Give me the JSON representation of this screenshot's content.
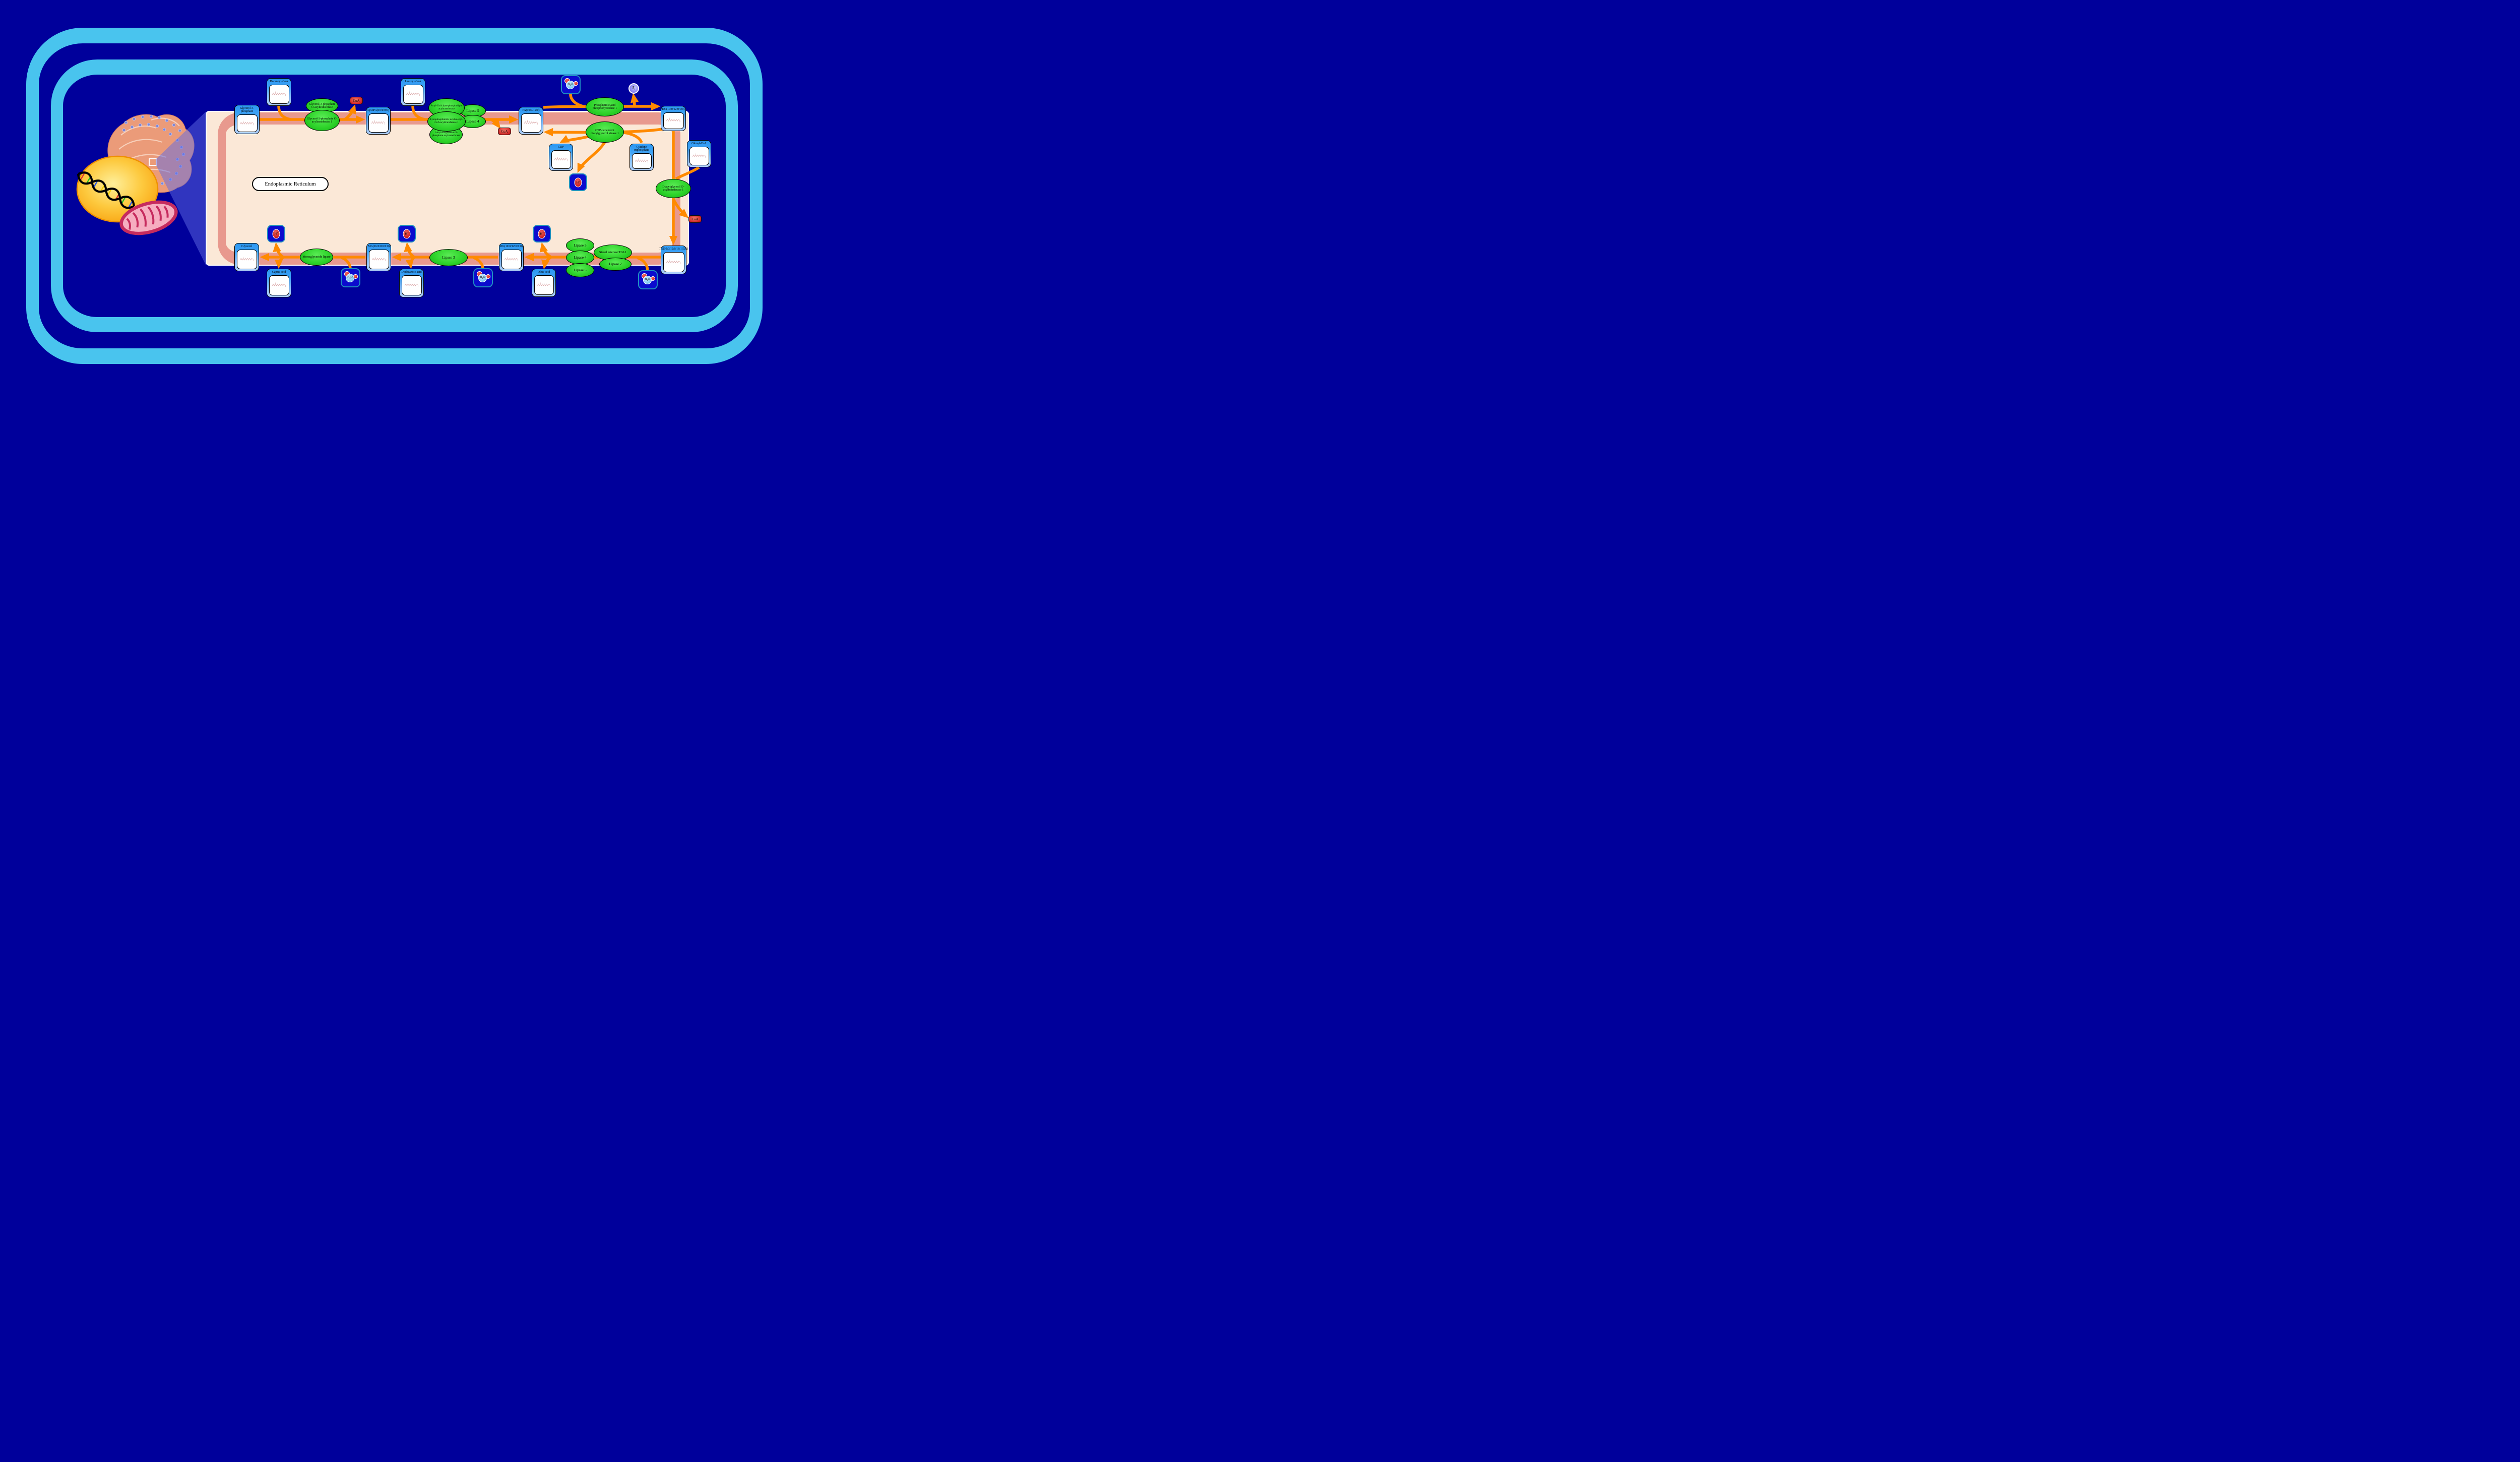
{
  "diagram": {
    "region_label": "Endoplasmic Reticulum"
  },
  "colors": {
    "background": "#00009B",
    "cell_membrane_ring": "#49C4EE",
    "er_membrane": "#E8998E",
    "er_lumen": "#FBE8D7",
    "arrow": "#FF8A00",
    "enzyme_green": "#2ED32A",
    "compound_header_blue": "#2B97F2",
    "ion_box_blue": "#0B0BCE",
    "ion_box_border": "#1F8FC0",
    "coa_red": "#CC1A1A",
    "pi_purple": "#8D86F2",
    "nucleus_yellow": "#FBA712",
    "mitochondrion_pink": "#C62B5E"
  },
  "metabolites": [
    {
      "id": "glycerol-3-phosphate",
      "label": "Glycerol 3-phosphate"
    },
    {
      "id": "decanoyl-coa",
      "label": "Decanoyl-CoA"
    },
    {
      "id": "lysopa",
      "label": "LysoPA(10:0/0:0)"
    },
    {
      "id": "lauroyl-coa",
      "label": "Lauroyl-CoA"
    },
    {
      "id": "pa",
      "label": "PA(10:0/12:0)"
    },
    {
      "id": "dg-top",
      "label": "DG(10:0/12:0/0:0)"
    },
    {
      "id": "cdp",
      "label": "CDP"
    },
    {
      "id": "cytidine-triphosphate",
      "label": "Cytidine triphosphate"
    },
    {
      "id": "oleoyl-coa",
      "label": "Oleoyl-CoA"
    },
    {
      "id": "tg",
      "label": "TG(10:0/12:0/18:1(9Z))"
    },
    {
      "id": "dg-bottom",
      "label": "DG(10:0/12:0/0:0)"
    },
    {
      "id": "oleic-acid",
      "label": "Oleic acid"
    },
    {
      "id": "mg",
      "label": "MG(16:0/0:0/0:0)"
    },
    {
      "id": "dodecanoic-acid",
      "label": "Dodecanoic acid"
    },
    {
      "id": "glycerol",
      "label": "Glycerol"
    },
    {
      "id": "capric-acid",
      "label": "Capric acid"
    }
  ],
  "enzymes": [
    {
      "id": "gpat",
      "label": "Glycerol-3-phosphate O-acyltransferase"
    },
    {
      "id": "gpat1",
      "label": "Glycerol-3-phosphate O-acyltransferase 1"
    },
    {
      "id": "lipase5-top",
      "label": "Lipase 5"
    },
    {
      "id": "lipase4-top",
      "label": "Lipase 4"
    },
    {
      "id": "acyl-coa-lysophospholipid-acyltransferase",
      "label": "Acyl-CoA:lyso-phospholipid acyltransferase"
    },
    {
      "id": "agpat",
      "label": "1-acyl-sn-glycerol-3-phosphate acyltransferase"
    },
    {
      "id": "lpaat1",
      "label": "Lysophosphatidic acid:oleoyl-CoA acyltransferase 1"
    },
    {
      "id": "pap1",
      "label": "Phosphatidic acid phosphohydrolase 1"
    },
    {
      "id": "cdgk1",
      "label": "CTP-dependent diacylglycerol kinase 1"
    },
    {
      "id": "dgat1",
      "label": "Diacylglycerol O-acyltransferase 1"
    },
    {
      "id": "mgl",
      "label": "Monoglyceride lipase"
    },
    {
      "id": "lipase3-mid",
      "label": "Lipase 3"
    },
    {
      "id": "lipase3-cluster",
      "label": "Lipase 3"
    },
    {
      "id": "sterol-esterase-tgl1",
      "label": "Sterol esterase TGL1"
    },
    {
      "id": "lipase2-cluster",
      "label": "Lipase 2"
    },
    {
      "id": "lipase4-cluster",
      "label": "Lipase 4"
    },
    {
      "id": "lipase5-cluster",
      "label": "Lipase 5"
    }
  ],
  "small_molecules": [
    {
      "id": "coa-1",
      "kind": "coa",
      "label": "CoA"
    },
    {
      "id": "coa-2",
      "kind": "coa",
      "label": "CoA"
    },
    {
      "id": "coa-3",
      "kind": "coa",
      "label": "CoA"
    },
    {
      "id": "h2o-top",
      "kind": "h2o",
      "formula": {
        "main": "H",
        "sub": "2",
        "tail": "O"
      }
    },
    {
      "id": "h2o-bottom-1",
      "kind": "h2o",
      "formula": {
        "main": "H",
        "sub": "2",
        "tail": "O"
      }
    },
    {
      "id": "h2o-bottom-2",
      "kind": "h2o",
      "formula": {
        "main": "H",
        "sub": "2",
        "tail": "O"
      }
    },
    {
      "id": "h2o-bottom-3",
      "kind": "h2o",
      "formula": {
        "main": "H",
        "sub": "2",
        "tail": "O"
      }
    },
    {
      "id": "h-plus-mid",
      "kind": "hplus",
      "formula": {
        "main": "H",
        "sup": "+"
      }
    },
    {
      "id": "h-plus-bottom-1",
      "kind": "hplus",
      "formula": {
        "main": "H",
        "sup": "+"
      }
    },
    {
      "id": "h-plus-bottom-2",
      "kind": "hplus",
      "formula": {
        "main": "H",
        "sup": "+"
      }
    },
    {
      "id": "h-plus-bottom-3",
      "kind": "hplus",
      "formula": {
        "main": "H",
        "sup": "+"
      }
    },
    {
      "id": "pi",
      "kind": "pi",
      "formula": {
        "main": "P",
        "sub": "i"
      }
    }
  ]
}
